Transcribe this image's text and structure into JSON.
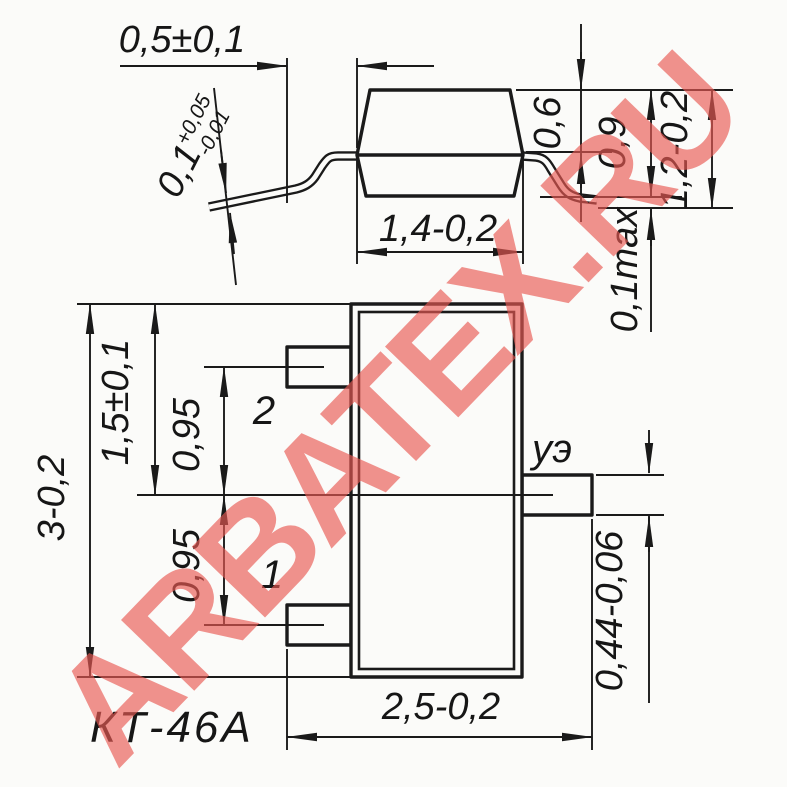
{
  "colors": {
    "line": "#1a1a1a",
    "background": "#fbfbf9",
    "watermark": "#e85a54"
  },
  "watermark": {
    "text": "ARBATEX.RU"
  },
  "package": {
    "name": "КТ-46А"
  },
  "side_view": {
    "lead_span": "0,5±0,1",
    "lead_thickness": "0,1",
    "lead_thickness_plus": "+0,05",
    "lead_thickness_minus": "-0,01",
    "body_width": "1,4-0,2",
    "cap_height": "0,6",
    "body_height": "0,9",
    "total_height": "1,2-0,2",
    "standoff": "0,1max"
  },
  "top_view": {
    "body_length": "3-0,2",
    "center_offset": "1,5±0,1",
    "pitch_upper": "0,95",
    "pitch_lower": "0,95",
    "total_width": "2,5-0,2",
    "lead_width": "0,44-0,06",
    "pin_upper": "2",
    "pin_lower": "1",
    "pin_gate": "уэ"
  }
}
